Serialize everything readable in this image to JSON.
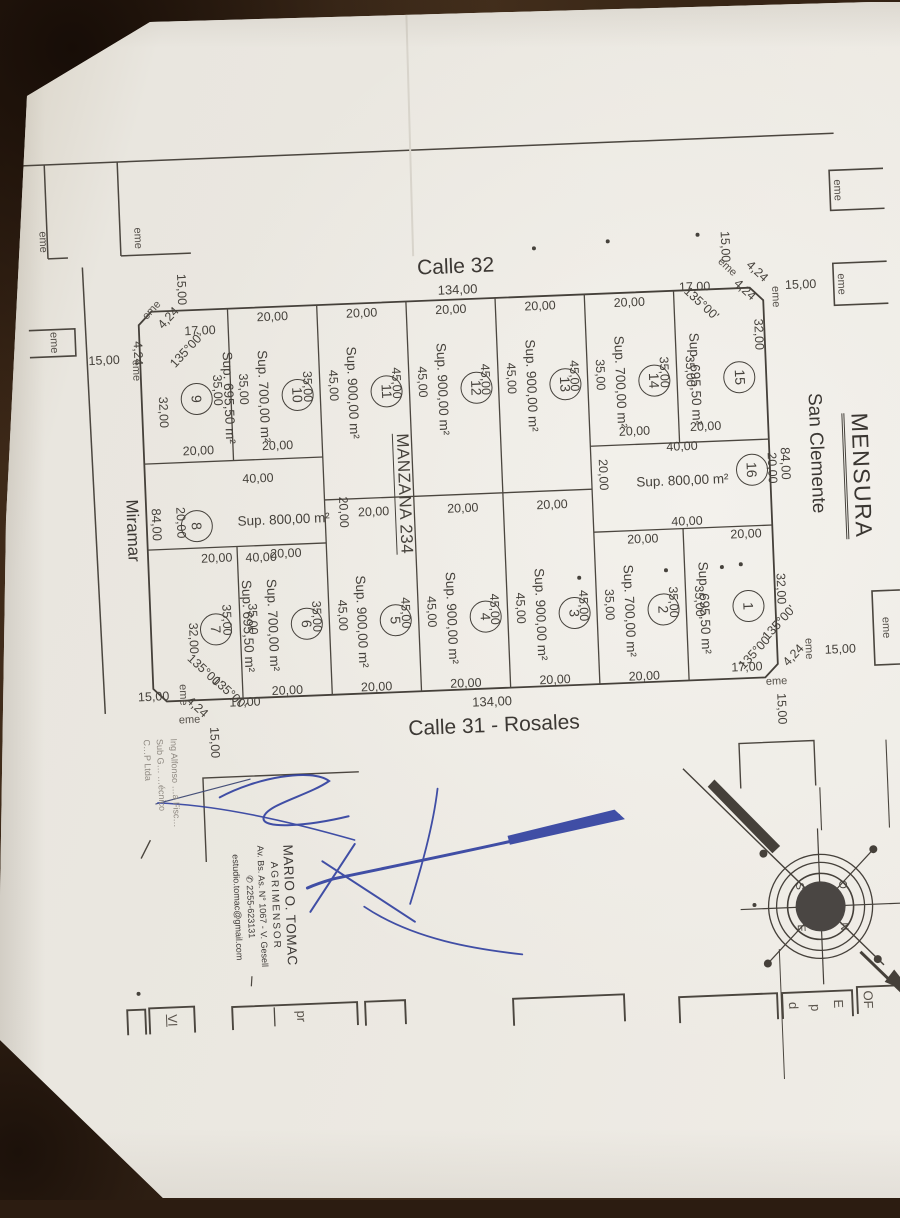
{
  "title": "MENSURA",
  "streets": {
    "top": "Calle 32",
    "bottom": "Calle 31 - Rosales",
    "right": "San Clemente",
    "left": "Miramar"
  },
  "block": {
    "name": "MANZANA 234",
    "frontage_total": "134,00",
    "side_total": "84,00"
  },
  "dims": {
    "lot_front": "20,00",
    "corner_front": "17,00",
    "corner_side": "32,00",
    "ochava": "4,24",
    "ochava_angle": "135°00'",
    "street_half": "15,00",
    "monument": "eme",
    "mid_width": "40,00",
    "mid_depth": "20,00"
  },
  "lots": [
    {
      "num": "1",
      "sup": "Sup. 695,50 m²",
      "depth": "35,00",
      "rear": "20,00"
    },
    {
      "num": "2",
      "sup": "Sup. 700,00 m²",
      "depth": "35,00",
      "front": "20,00",
      "rear": "20,00"
    },
    {
      "num": "3",
      "sup": "Sup. 900,00 m²",
      "depth": "45,00",
      "front": "20,00",
      "rear": "20,00"
    },
    {
      "num": "4",
      "sup": "Sup. 900,00 m²",
      "depth": "45,00",
      "front": "20,00",
      "rear": "20,00"
    },
    {
      "num": "5",
      "sup": "Sup. 900,00 m²",
      "depth": "45,00",
      "front": "20,00",
      "rear": "20,00"
    },
    {
      "num": "6",
      "sup": "Sup. 700,00 m²",
      "depth": "35,00",
      "front": "20,00",
      "rear": "20,00"
    },
    {
      "num": "7",
      "sup": "Sup. 695,50 m²",
      "depth": "35,00",
      "rear": "20,00"
    },
    {
      "num": "8",
      "sup": "Sup. 800,00 m²",
      "width": "40,00",
      "depth": "20,00"
    },
    {
      "num": "9",
      "sup": "Sup. 695,50 m²",
      "depth": "35,00",
      "rear": "20,00"
    },
    {
      "num": "10",
      "sup": "Sup. 700,00 m²",
      "depth": "35,00",
      "front": "20,00",
      "rear": "20,00"
    },
    {
      "num": "11",
      "sup": "Sup. 900,00 m²",
      "depth": "45,00",
      "front": "20,00"
    },
    {
      "num": "12",
      "sup": "Sup. 900,00 m²",
      "depth": "45,00",
      "front": "20,00"
    },
    {
      "num": "13",
      "sup": "Sup. 900,00 m²",
      "depth": "45,00",
      "front": "20,00"
    },
    {
      "num": "14",
      "sup": "Sup. 700,00 m²",
      "depth": "35,00",
      "front": "20,00",
      "rear": "20,00"
    },
    {
      "num": "15",
      "sup": "Sup. 695,50 m²",
      "depth": "35,00",
      "rear": "20,00"
    },
    {
      "num": "16",
      "sup": "Sup. 800,00 m²",
      "width": "40,00",
      "depth": "20,00"
    }
  ],
  "professional": {
    "name": "MARIO O. TOMAC",
    "role": "AGRIMENSOR",
    "address": "Av. Bs. As. N° 1067 - V. Gesell",
    "phone": "✆ 2255-623131",
    "email": "estudio.tomac@gmail.com"
  },
  "stamp": {
    "line1": "Ing Alfonso …a Fisc…",
    "line2": "Sub G… …écnico",
    "line3": "C…P Ltda"
  },
  "compass": {
    "n": "N",
    "s": "S",
    "e": "E",
    "o": "O"
  },
  "form_boxes": {
    "vi": "VI",
    "pr": "pr",
    "e": "E",
    "p": "p",
    "d": "d",
    "of": "OF"
  },
  "colors": {
    "paper": "#e9e6df",
    "background": "#3a2818",
    "ink": "#46423c",
    "signature": "#2e3e9f"
  }
}
